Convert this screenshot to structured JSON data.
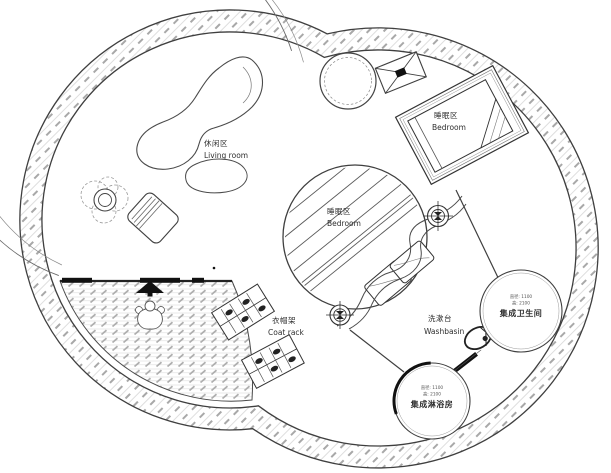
{
  "plan": {
    "areas": {
      "living_room": {
        "zh": "休闲区",
        "en": "Living room"
      },
      "bedroom_upper": {
        "zh": "睡眠区",
        "en": "Bedroom"
      },
      "bedroom_center": {
        "zh": "睡眠区",
        "en": "Bedroom"
      },
      "coat_rack": {
        "zh": "衣帽架",
        "en": "Coat rack"
      },
      "washbasin": {
        "zh": "洗漱台",
        "en": "Washbasin"
      },
      "bathroom_pod": {
        "spec_diameter": "直径: 1100",
        "spec_height": "高: 2100",
        "name": "集成卫生间"
      },
      "shower_pod": {
        "spec_diameter": "直径: 1100",
        "spec_height": "高: 2100",
        "name": "集成淋浴房"
      }
    },
    "colors": {
      "line": "#3f3f3f",
      "wall_hatch_light": "#d6d6d6",
      "wall_hatch_dash": "#a8a8a8",
      "deck_hatch": "#dcdcdc",
      "black_fill": "#111111",
      "background": "#ffffff"
    }
  }
}
